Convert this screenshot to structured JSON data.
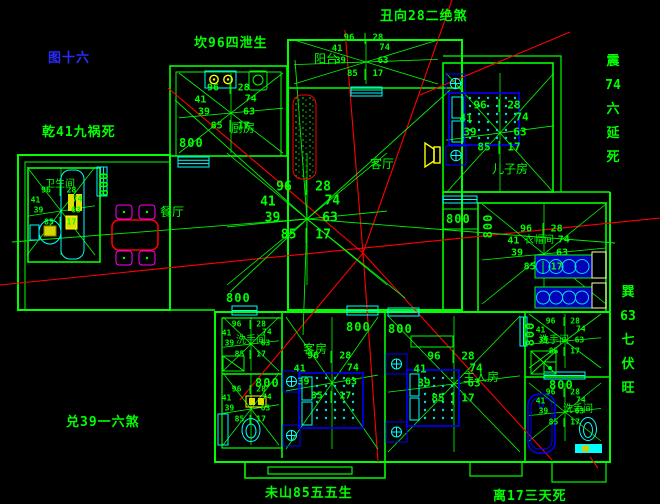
{
  "colors": {
    "background": "#000000",
    "line_green": "#00ff00",
    "window_cyan": "#00ffff",
    "orientation_red": "#ff0000",
    "furniture_blue": "#0000ee",
    "chair_magenta": "#ff00ff",
    "fixture_yellow": "#ffff00",
    "figure_label_blue": "#2b2bff"
  },
  "annotations": [
    {
      "name": "chou-xiang-annotation",
      "text": "丑向28二绝煞",
      "x": 380,
      "y": 5
    },
    {
      "name": "kan-annotation",
      "text": "坎96四泄生",
      "x": 194,
      "y": 32
    },
    {
      "name": "figure-number",
      "text": "图十六",
      "x": 48,
      "y": 47,
      "color": "#2b2bff"
    },
    {
      "name": "qian-annotation",
      "text": "乾41九祸死",
      "x": 42,
      "y": 121
    },
    {
      "name": "zhen-annotation",
      "segments": [
        "震",
        "74",
        "六",
        "延",
        "死"
      ],
      "x": 602,
      "y": 50,
      "vertical": true
    },
    {
      "name": "xun-annotation",
      "segments": [
        "巽",
        "63",
        "七",
        "伏",
        "旺"
      ],
      "x": 617,
      "y": 281,
      "vertical": true
    },
    {
      "name": "dui-annotation",
      "text": "兑39一六煞",
      "x": 66,
      "y": 411
    },
    {
      "name": "wei-shan-annotation",
      "text": "未山85五五生",
      "x": 265,
      "y": 482
    },
    {
      "name": "li-annotation",
      "text": "离17三天死",
      "x": 493,
      "y": 485
    }
  ],
  "room_labels": [
    {
      "name": "room-label-kitchen",
      "text": "厨房",
      "x": 231,
      "y": 119,
      "size": 12
    },
    {
      "name": "room-label-balcony",
      "text": "阳台",
      "x": 314,
      "y": 50,
      "size": 12
    },
    {
      "name": "room-label-living",
      "text": "客厅",
      "x": 370,
      "y": 155,
      "size": 12
    },
    {
      "name": "room-label-dining",
      "text": "餐厅",
      "x": 160,
      "y": 203,
      "size": 12
    },
    {
      "name": "room-label-son",
      "text": "儿子房",
      "x": 492,
      "y": 160,
      "size": 12
    },
    {
      "name": "room-label-bath-left",
      "text": "卫生间",
      "x": 45,
      "y": 175,
      "size": 10
    },
    {
      "name": "room-label-cloakroom",
      "text": "衣帽间",
      "x": 524,
      "y": 231,
      "size": 10
    },
    {
      "name": "room-label-guest",
      "text": "客房",
      "x": 303,
      "y": 340,
      "size": 12
    },
    {
      "name": "room-label-wash-1",
      "text": "洗手间",
      "x": 236,
      "y": 331,
      "size": 10
    },
    {
      "name": "room-label-master",
      "text": "主人房",
      "x": 463,
      "y": 368,
      "size": 12
    },
    {
      "name": "room-label-wash-2",
      "text": "洗手间",
      "x": 539,
      "y": 331,
      "size": 10
    },
    {
      "name": "room-label-wash-3",
      "text": "洗手间",
      "x": 563,
      "y": 400,
      "size": 10
    }
  ],
  "dimension_value": "800",
  "dimensions": [
    {
      "x": 179,
      "y": 136
    },
    {
      "x": 104,
      "y": 184,
      "vertical": true
    },
    {
      "x": 226,
      "y": 291
    },
    {
      "x": 255,
      "y": 376
    },
    {
      "x": 346,
      "y": 320
    },
    {
      "x": 388,
      "y": 322
    },
    {
      "x": 446,
      "y": 212
    },
    {
      "x": 488,
      "y": 226,
      "vertical": true
    },
    {
      "x": 530,
      "y": 334,
      "vertical": true
    },
    {
      "x": 549,
      "y": 378
    }
  ],
  "compass_numbers": {
    "top_left": "96",
    "top_right": "28",
    "upper_left": "41",
    "upper_right": "74",
    "left": "39",
    "right": "63",
    "bottom_left": "85",
    "bottom_right": "17"
  },
  "compasses": [
    {
      "name": "kitchen",
      "x": 231,
      "y": 113,
      "s": 0.9,
      "rx": 52,
      "ry": 40
    },
    {
      "name": "balcony",
      "x": 366,
      "y": 62,
      "s": 0.85,
      "rx": 72,
      "ry": 22
    },
    {
      "name": "son-room",
      "x": 500,
      "y": 133,
      "s": 1.0,
      "rx": 54,
      "ry": 60
    },
    {
      "name": "bath-left",
      "x": 61,
      "y": 211,
      "s": 0.75,
      "rx": 34,
      "ry": 44
    },
    {
      "name": "house-center",
      "x": 307,
      "y": 219,
      "s": 1.15,
      "rx": 80,
      "ry": 66
    },
    {
      "name": "cloakroom",
      "x": 544,
      "y": 254,
      "s": 0.9,
      "rx": 62,
      "ry": 50
    },
    {
      "name": "wash-top",
      "x": 251,
      "y": 344,
      "s": 0.72,
      "rx": 28,
      "ry": 27
    },
    {
      "name": "wash-bottom",
      "x": 251,
      "y": 409,
      "s": 0.72,
      "rx": 28,
      "ry": 36
    },
    {
      "name": "guest-room",
      "x": 332,
      "y": 383,
      "s": 0.95,
      "rx": 46,
      "ry": 66
    },
    {
      "name": "master-room",
      "x": 454,
      "y": 384,
      "s": 1.0,
      "rx": 66,
      "ry": 68
    },
    {
      "name": "bath-tr",
      "x": 565,
      "y": 341,
      "s": 0.72,
      "rx": 36,
      "ry": 27
    },
    {
      "name": "bath-br",
      "x": 565,
      "y": 412,
      "s": 0.72,
      "rx": 36,
      "ry": 29
    }
  ]
}
